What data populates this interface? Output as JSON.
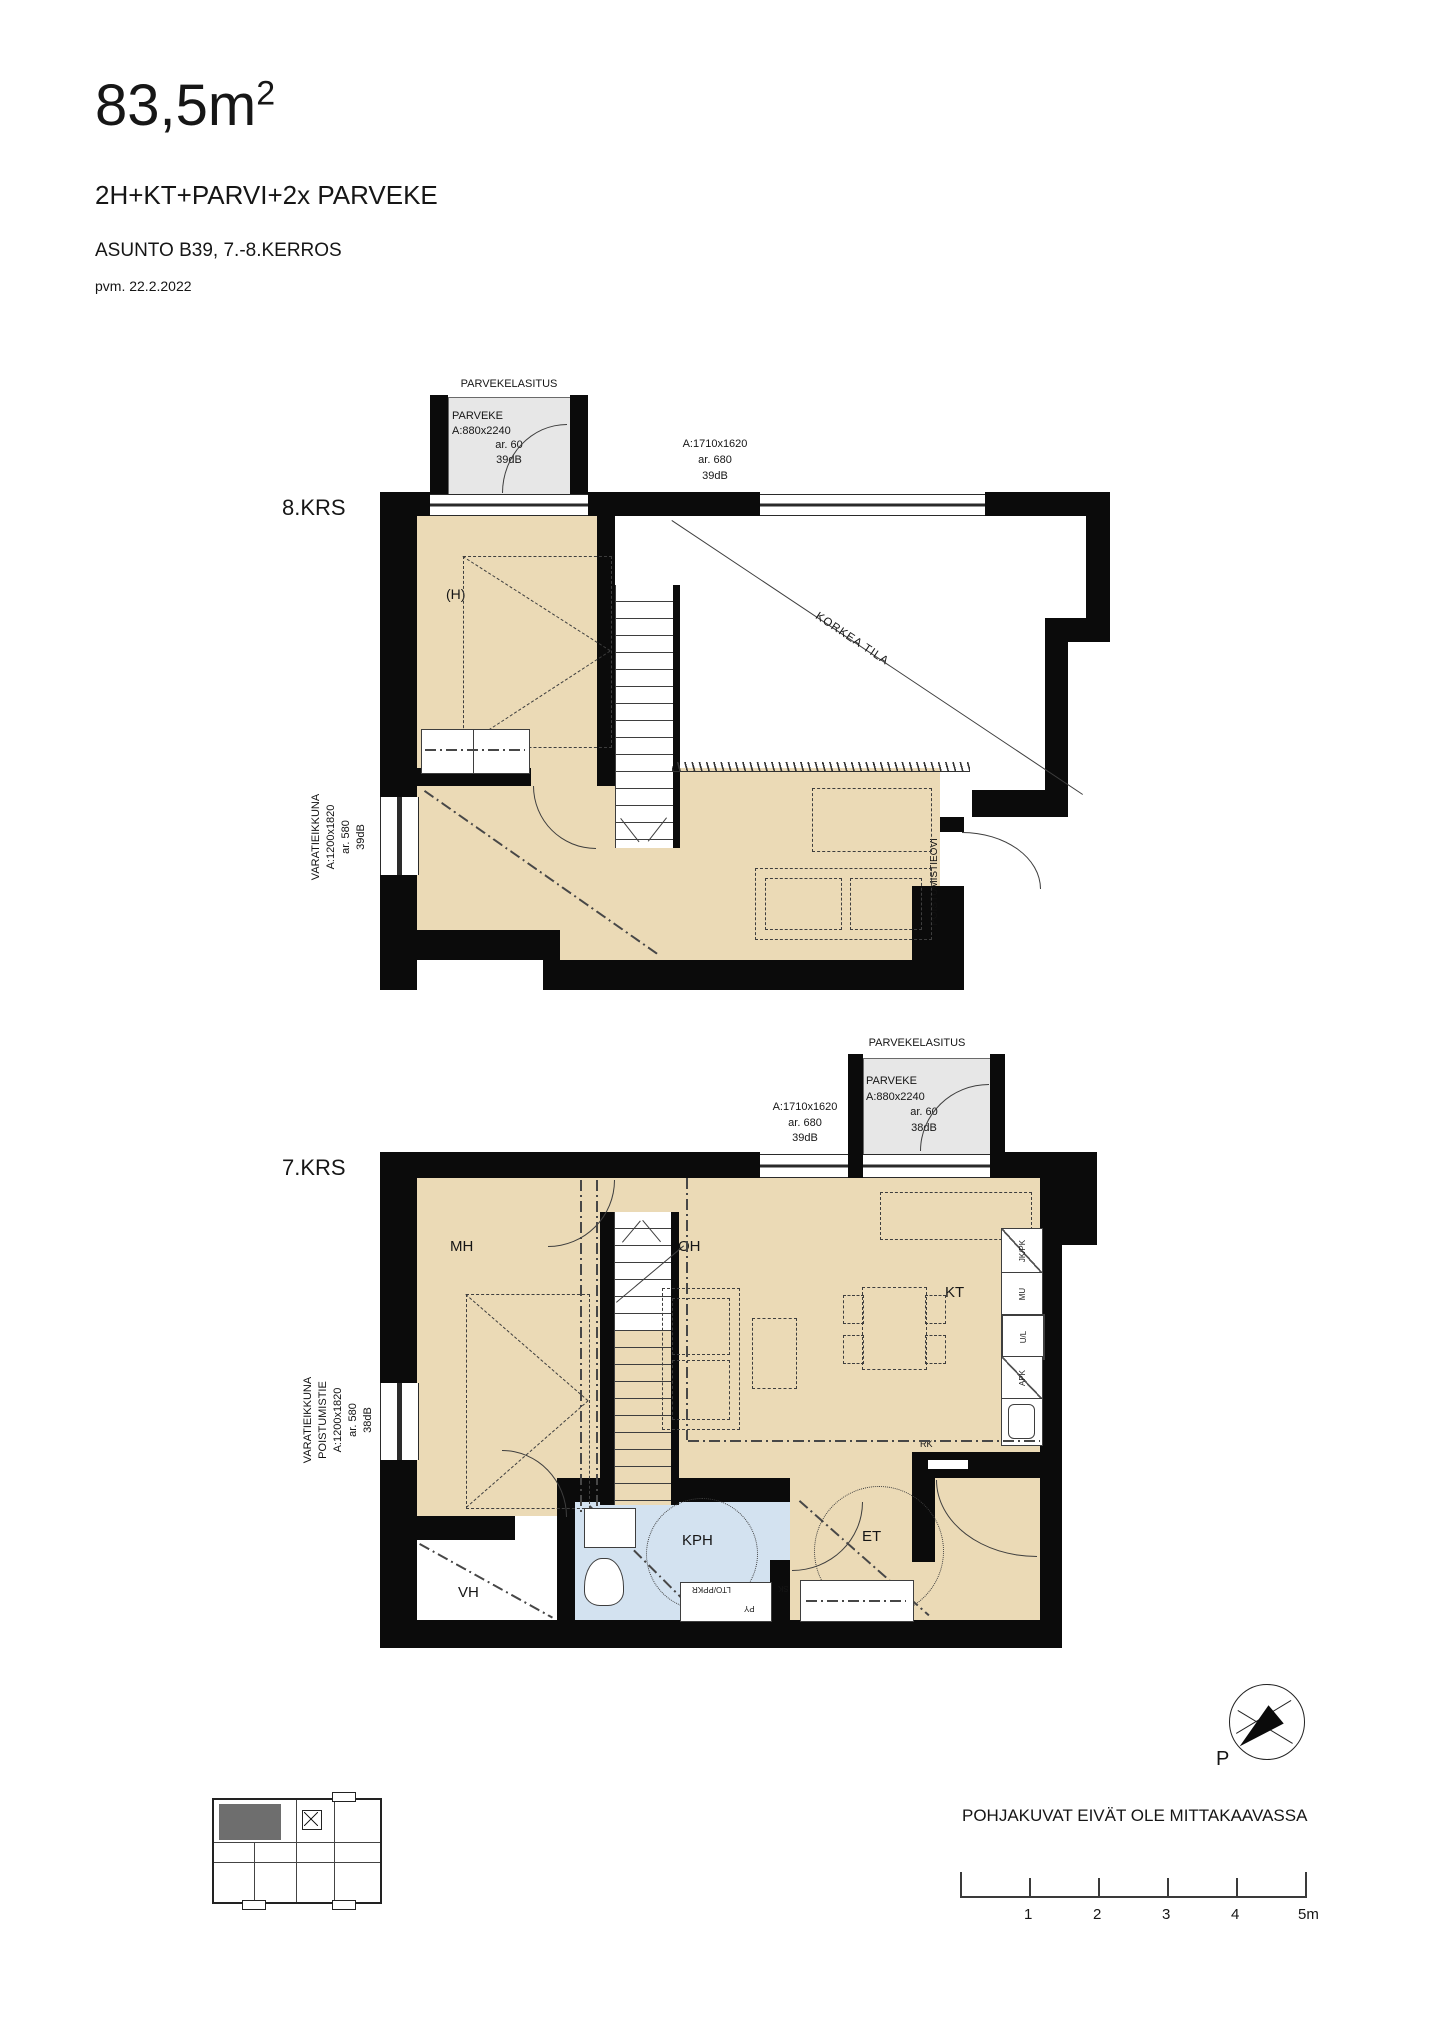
{
  "header": {
    "area": "83,5m",
    "area_sup": "2",
    "layout": "2H+KT+PARVI+2x PARVEKE",
    "apartment": "ASUNTO B39, 7.-8.KERROS",
    "date": "pvm. 22.2.2022"
  },
  "plan8": {
    "floor": "8.KRS",
    "glazing": "PARVEKELASITUS",
    "balcony": {
      "name": "PARVEKE",
      "dim": "A:880x2240",
      "ar": "ar. 60",
      "db": "39dB"
    },
    "top_window": {
      "dim": "A:1710x1620",
      "ar": "ar. 680",
      "db": "39dB"
    },
    "left_window": {
      "l1": "VARATIEIKKUNA",
      "l2": "A:1200x1820",
      "l3": "ar. 580",
      "l4": "39dB"
    },
    "room_h": "(H)",
    "open_space": "KORKEA TILA",
    "exit_door": "POISTUMISTIEOVI"
  },
  "plan7": {
    "floor": "7.KRS",
    "glazing": "PARVEKELASITUS",
    "balcony": {
      "name": "PARVEKE",
      "dim": "A:880x2240",
      "ar": "ar. 60",
      "db": "38dB"
    },
    "top_window": {
      "dim": "A:1710x1620",
      "ar": "ar. 680",
      "db": "39dB"
    },
    "left_window": {
      "l1": "VARATIEIKKUNA",
      "l2": "POISTUMISTIE",
      "l3": "A:1200x1820",
      "l4": "ar. 580",
      "l5": "38dB"
    },
    "rooms": {
      "mh": "MH",
      "oh": "OH",
      "kt": "KT",
      "vh": "VH",
      "kph": "KPH",
      "et": "ET"
    },
    "appliances": {
      "jkpk": "JK/PK",
      "mu": "MU",
      "ul": "U/L",
      "apk": "APK"
    },
    "small": {
      "rk": "RK",
      "lto": "LTO/PPKR",
      "py": "PY",
      "sk": "SK"
    }
  },
  "footer": {
    "north": "P",
    "disclaimer": "POHJAKUVAT EIVÄT OLE MITTAKAAVASSA",
    "ticks": [
      "1",
      "2",
      "3",
      "4",
      "5m"
    ]
  },
  "colors": {
    "floor_tan": "#ebdab6",
    "bath_blue": "#d3e2f0",
    "balcony_gray": "#e7e7e7",
    "wall_black": "#0b0b0b"
  }
}
